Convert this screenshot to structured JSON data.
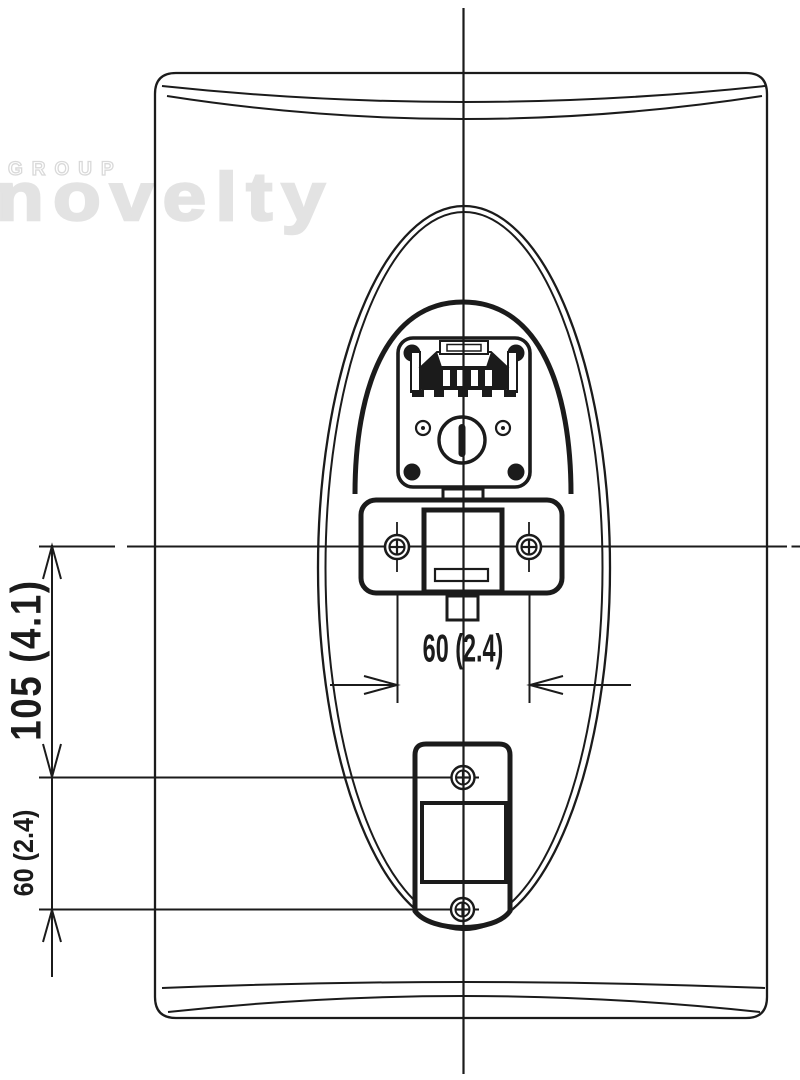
{
  "watermark": {
    "group": "GROUP",
    "brand": "novelty"
  },
  "dimensions": {
    "vertical_hole_spacing": "105 (4.1)",
    "vertical_lower_spacing": "60 (2.4)",
    "horizontal_hole_spacing": "60 (2.4)"
  },
  "colors": {
    "line": "#1b1b1b",
    "watermark": "#e3e3e3",
    "background": "#ffffff"
  }
}
